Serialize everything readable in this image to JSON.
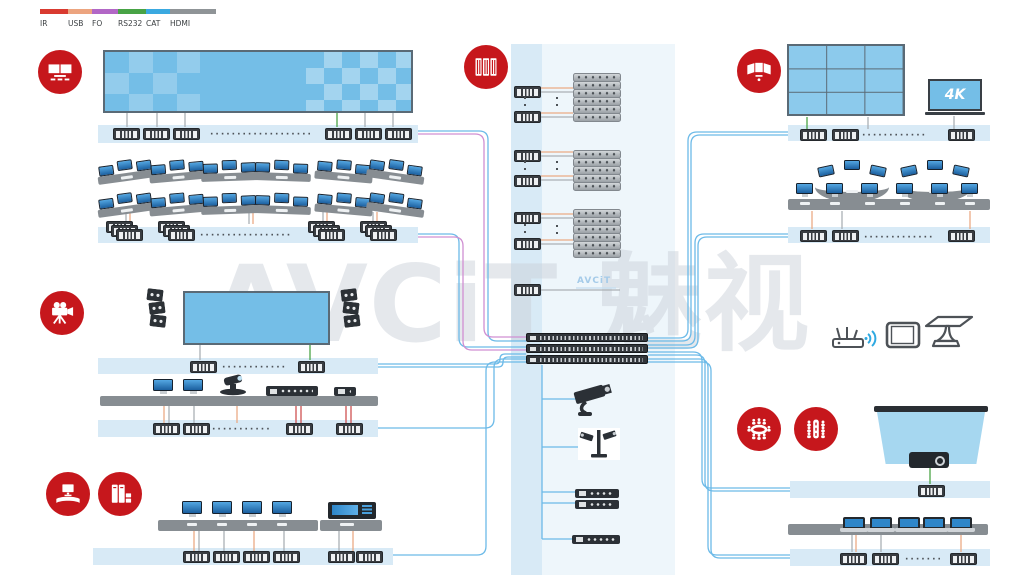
{
  "legend": {
    "items": [
      {
        "label": "IR",
        "color": "#d93a30"
      },
      {
        "label": "USB",
        "color": "#eca47f"
      },
      {
        "label": "FO",
        "color": "#b267c6"
      },
      {
        "label": "RS232",
        "color": "#48a345"
      },
      {
        "label": "CAT",
        "color": "#3aa9e0"
      },
      {
        "label": "HDMI",
        "color": "#8f9497"
      }
    ]
  },
  "watermark_text": "AVCiT 魅视",
  "center_logo_text": "AVCiT",
  "labels": {
    "tv_4k": "4K"
  },
  "ellipsis_char": "·",
  "badge_color": "#c6171c",
  "line_colors": {
    "cat_blue": "#6cbae8",
    "fo_pink": "#d08fd2",
    "rs232_green": "#4aa546",
    "usb_orange": "#ecab85",
    "ir_red": "#d05050",
    "hdmi_gray": "#aab0b5"
  },
  "badges": [
    "video-wall",
    "server-racks",
    "curved-video-wall",
    "video-camera",
    "operator-desk",
    "pc-towers",
    "conference-table",
    "meeting-table"
  ],
  "sections": {
    "top_left_video_wall": {
      "decoders": 6
    },
    "control_room_left": {
      "rows": 2,
      "console_segments_per_row": 6,
      "monitors_per_segment": 3,
      "encoder_stacks": 4
    },
    "presentation_room_left": {
      "screens": 1,
      "speaker_arrays": 2,
      "devices": [
        "monitor",
        "monitor",
        "ptz-camera",
        "conference-host",
        "dome-camera"
      ],
      "encoders": 4
    },
    "operator_area_bottom_left": {
      "monitors": 4,
      "control_consoles": 1,
      "encoders": 6
    },
    "center": {
      "encoder_nodes": 7,
      "server_stacks": 3,
      "servers_per_stack": [
        6,
        5,
        6
      ],
      "matrix_switchers": 3,
      "peripherals": [
        "cctv-camera",
        "camera-station",
        "recorder",
        "recorder",
        "network-switch"
      ]
    },
    "top_right": {
      "video_wall_grid": "3x3",
      "tv": "4K",
      "decoders": 3
    },
    "control_room_right": {
      "curved_consoles": 2,
      "desk_monitors": 6,
      "decoders": 3,
      "wireless_devices": [
        "wifi-router",
        "tablet",
        "conference-table"
      ]
    },
    "meeting_room_bottom_right": {
      "projection_screens": 1,
      "projectors": 1,
      "laptops": 5,
      "encoders": 4
    }
  }
}
